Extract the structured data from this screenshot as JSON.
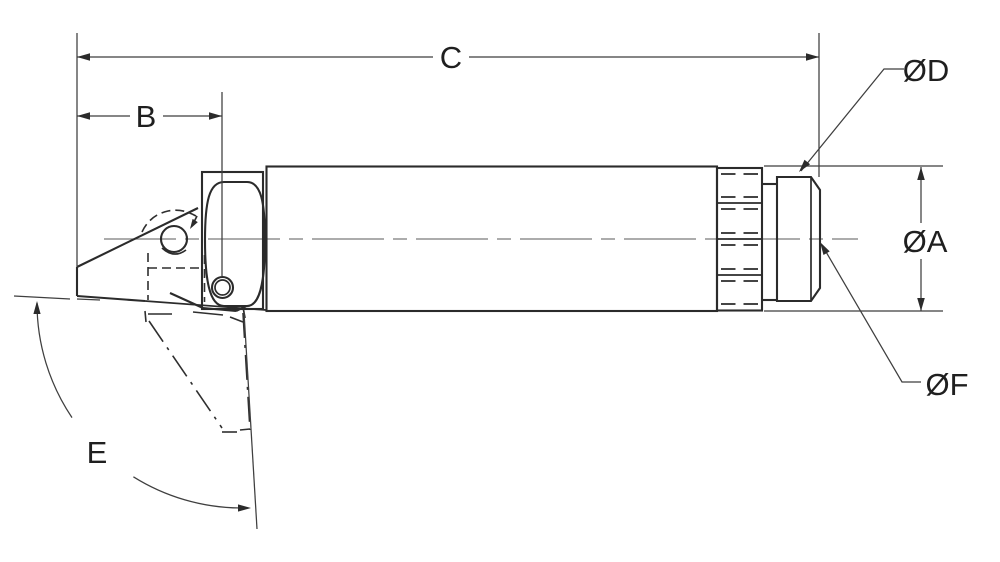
{
  "drawing": {
    "kind": "engineering-dimension-drawing",
    "labels": {
      "c": "C",
      "b": "B",
      "d": "ØD",
      "a": "ØA",
      "f": "ØF",
      "e": "E"
    },
    "colors": {
      "background": "#ffffff",
      "object_line": "#2b2b2b",
      "dimension_line": "#3f3f3f",
      "centerline": "#7a7a7a",
      "text": "#1f1f1f"
    }
  }
}
